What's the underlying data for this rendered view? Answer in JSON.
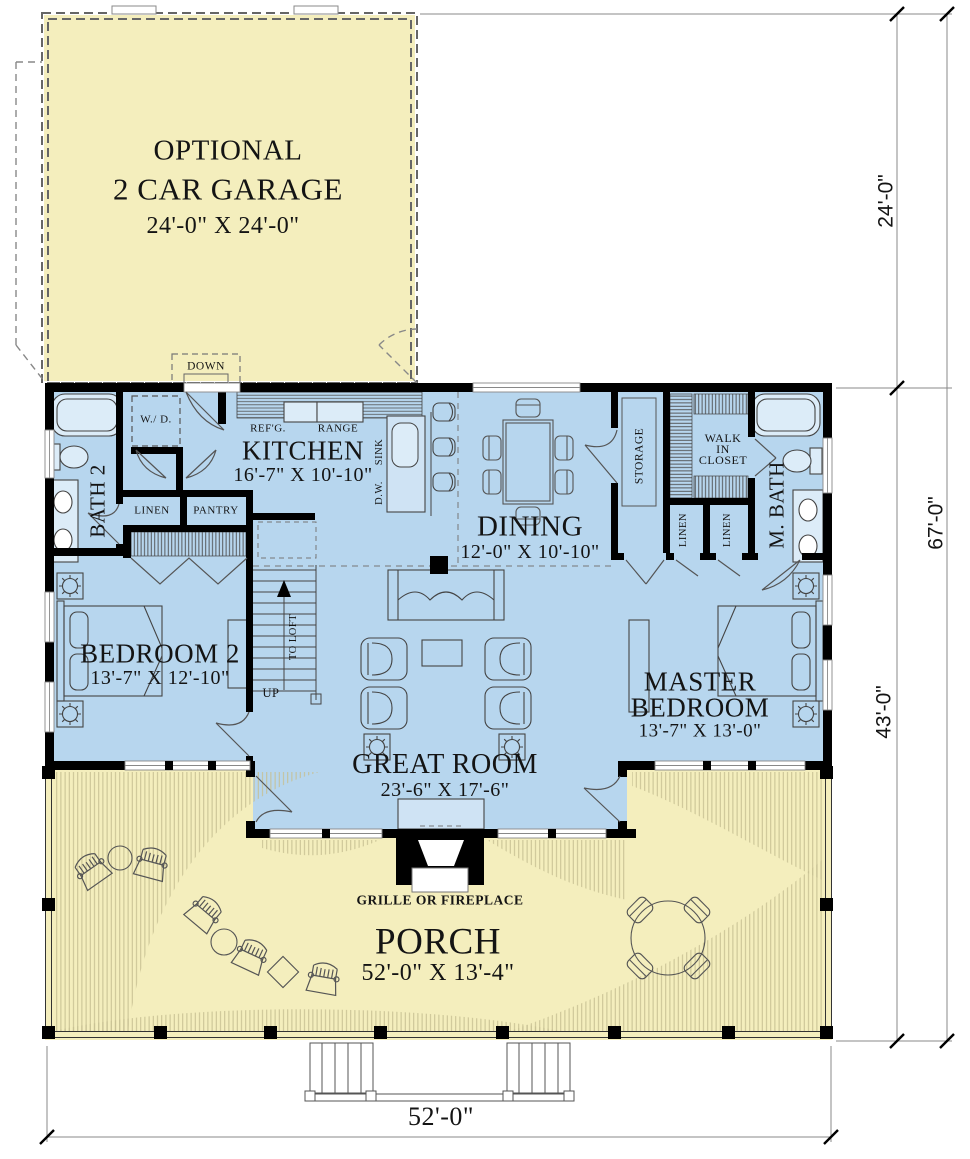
{
  "rooms": {
    "garage": {
      "line1": "OPTIONAL",
      "line2": "2 CAR GARAGE",
      "dims": "24'-0\" X 24'-0\""
    },
    "kitchen": {
      "name": "KITCHEN",
      "dims": "16'-7\" X 10'-10\""
    },
    "dining": {
      "name": "DINING",
      "dims": "12'-0\" X 10'-10\""
    },
    "great_room": {
      "name": "GREAT ROOM",
      "dims": "23'-6\" X 17'-6\""
    },
    "bedroom2": {
      "name": "BEDROOM 2",
      "dims": "13'-7\" X 12'-10\""
    },
    "master_bedroom": {
      "line1": "MASTER",
      "line2": "BEDROOM",
      "dims": "13'-7\" X 13'-0\""
    },
    "porch": {
      "name": "PORCH",
      "dims": "52'-0\" X 13'-4\""
    },
    "bath2": {
      "name": "BATH 2"
    },
    "master_bath": {
      "name": "M. BATH"
    },
    "walk_in_closet": {
      "line1": "WALK",
      "line2": "IN",
      "line3": "CLOSET"
    },
    "storage": {
      "name": "STORAGE"
    }
  },
  "fixtures": {
    "washer_dryer": "W./ D.",
    "refrigerator": "REF'G.",
    "range": "RANGE",
    "sink": "SINK",
    "dishwasher": "D.W.",
    "linen_hall": "LINEN",
    "pantry": "PANTRY",
    "linen_master_1": "LINEN",
    "linen_master_2": "LINEN",
    "stairs_down": "DOWN",
    "stairs_up": "UP",
    "stairs_to_loft": "TO LOFT",
    "grille": "GRILLE OR FIREPLACE"
  },
  "dimensions": {
    "garage_depth": "24'-0\"",
    "overall_depth": "67'-0\"",
    "main_depth": "43'-0\"",
    "overall_width": "52'-0\""
  },
  "colors": {
    "interior": "#b7d6ee",
    "outdoor": "#f4eebd",
    "wall": "#000000",
    "porch_hatch": "#c6bf92"
  }
}
